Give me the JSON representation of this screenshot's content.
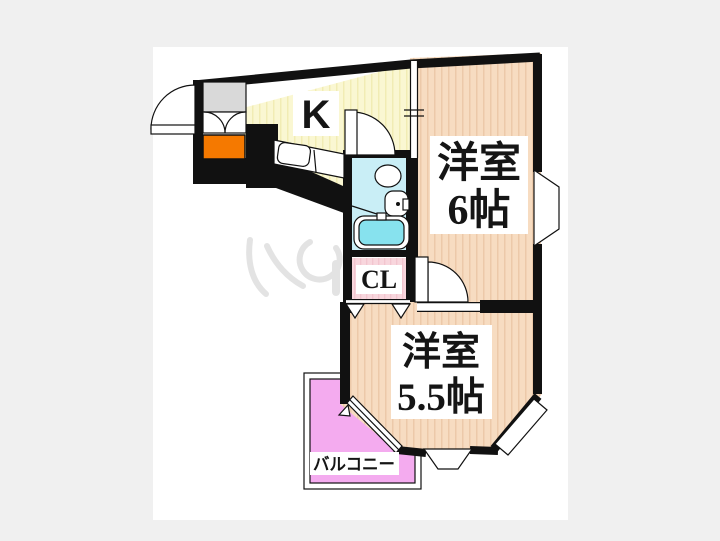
{
  "page": {
    "background_color": "#f0f0f0",
    "paper_color": "#ffffff"
  },
  "floorplan": {
    "type": "apartment-floor-plan",
    "labels": {
      "kitchen": "K",
      "room6_name": "洋室",
      "room6_size": "6帖",
      "room55_name": "洋室",
      "room55_size": "5.5帖",
      "closet": "CL",
      "balcony": "バルコニー"
    },
    "colors": {
      "wall": "#111111",
      "room_floor": "#f7dcc1",
      "room_stripe": "#ecc9a9",
      "kitchen_floor": "#faf7d2",
      "kitchen_stripe": "#f1ecb4",
      "bath": "#c9eef6",
      "bathtub": "#87e2ee",
      "closet": "#f8d6dd",
      "closet_stripe": "#f2c5cf",
      "balcony": "#f4abef",
      "shoe_box": "#f57900",
      "entry_floor": "#d9d9d9"
    }
  }
}
